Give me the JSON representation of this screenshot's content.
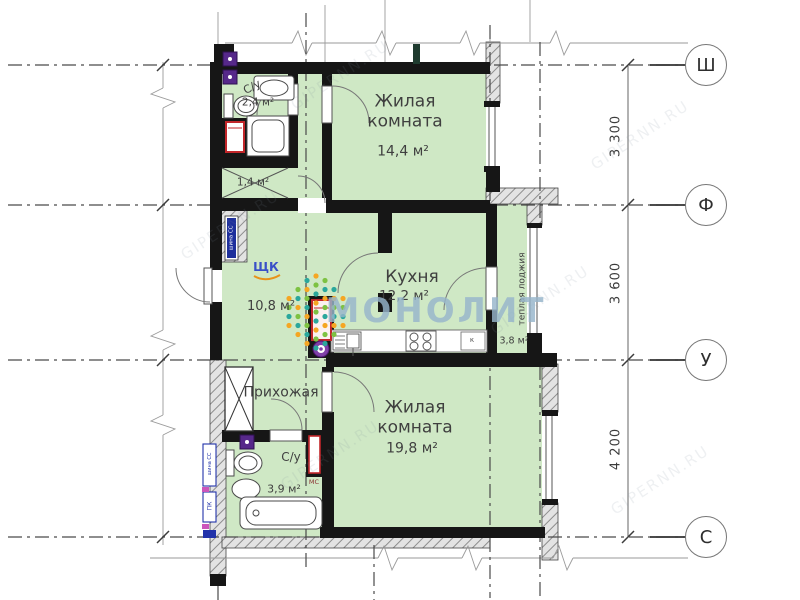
{
  "watermark": {
    "brand": "МОНОЛИТ",
    "diagonal": "GIPERNN.RU"
  },
  "rooms": {
    "living_top": {
      "name": "Жилая комната",
      "area": "14,4 м²"
    },
    "kitchen": {
      "name": "Кухня",
      "area": "12,2 м²"
    },
    "living_bottom": {
      "name": "Жилая комната",
      "area": "19,8 м²"
    },
    "hall": {
      "area": "10,8 м²"
    },
    "entry": {
      "name": "Прихожая"
    },
    "bathroom_top": {
      "name": "С/у",
      "area": "2,4 м²"
    },
    "bathroom_bottom": {
      "name": "С/у",
      "area": "3,9 м²"
    },
    "closet": {
      "area": "1,4 м²"
    },
    "loggia": {
      "name": "теплая лоджия",
      "area": "3,8 м²"
    }
  },
  "axes": [
    {
      "label": "Ш"
    },
    {
      "label": "Ф"
    },
    {
      "label": "У"
    },
    {
      "label": "С"
    }
  ],
  "dimensions": [
    {
      "value": "3 300"
    },
    {
      "value": "3 600"
    },
    {
      "value": "4 200"
    }
  ],
  "annotations": {
    "shk": "ЩК",
    "ms": "МС",
    "k": "к",
    "panel": "шина СС",
    "pk": "ПК"
  },
  "colors": {
    "room_fill": "#cfe8c5",
    "wall": "#161616",
    "fixture_red": "#c2262a",
    "marker_purple": "#56288a",
    "panel_blue": "#1e2f9c",
    "shk_blue": "#3a50c8",
    "underline_orange": "#e8921a",
    "watermark_blue": "#96b5cb",
    "logo_green": "#7dc242",
    "logo_orange": "#f5a623",
    "logo_teal": "#2aa79c"
  }
}
